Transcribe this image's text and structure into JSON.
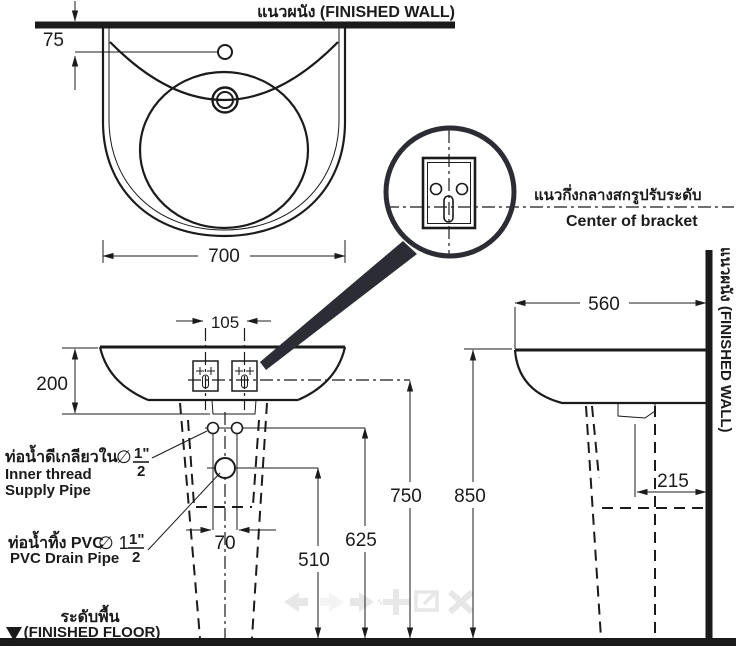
{
  "labels": {
    "wall_top": "แนวผนัง  (FINISHED WALL)",
    "wall_right": "แนวผนัง  (FINISHED WALL)",
    "floor_th": "ระดับพื้น",
    "floor_en": "(FINISHED FLOOR)",
    "bracket_th": "แนวกึ่งกลางสกรูปรับระดับ",
    "bracket_en": "Center of bracket",
    "supply": {
      "th": "ท่อน้ำดีเกลียวใน",
      "dia": "∅",
      "num": "1\"",
      "den": "2",
      "en1": "Inner thread",
      "en2": "Supply Pipe"
    },
    "drain": {
      "th": "ท่อน้ำทิ้ง PVC",
      "dia": "∅ 1",
      "num": "1\"",
      "den": "2",
      "en": "PVC Drain Pipe"
    }
  },
  "dims": {
    "wall_to_hole": "75",
    "width": "700",
    "bracket_span": "105",
    "basin_height": "200",
    "supply_span": "70",
    "drain_height": "510",
    "supply_height": "625",
    "bracket_height": "750",
    "rim_height": "850",
    "depth": "560",
    "drain_offset": "215"
  },
  "colors": {
    "line": "#1b1b1b",
    "magnifier": "#2c2c34",
    "watermark": "#e7e7e7"
  }
}
